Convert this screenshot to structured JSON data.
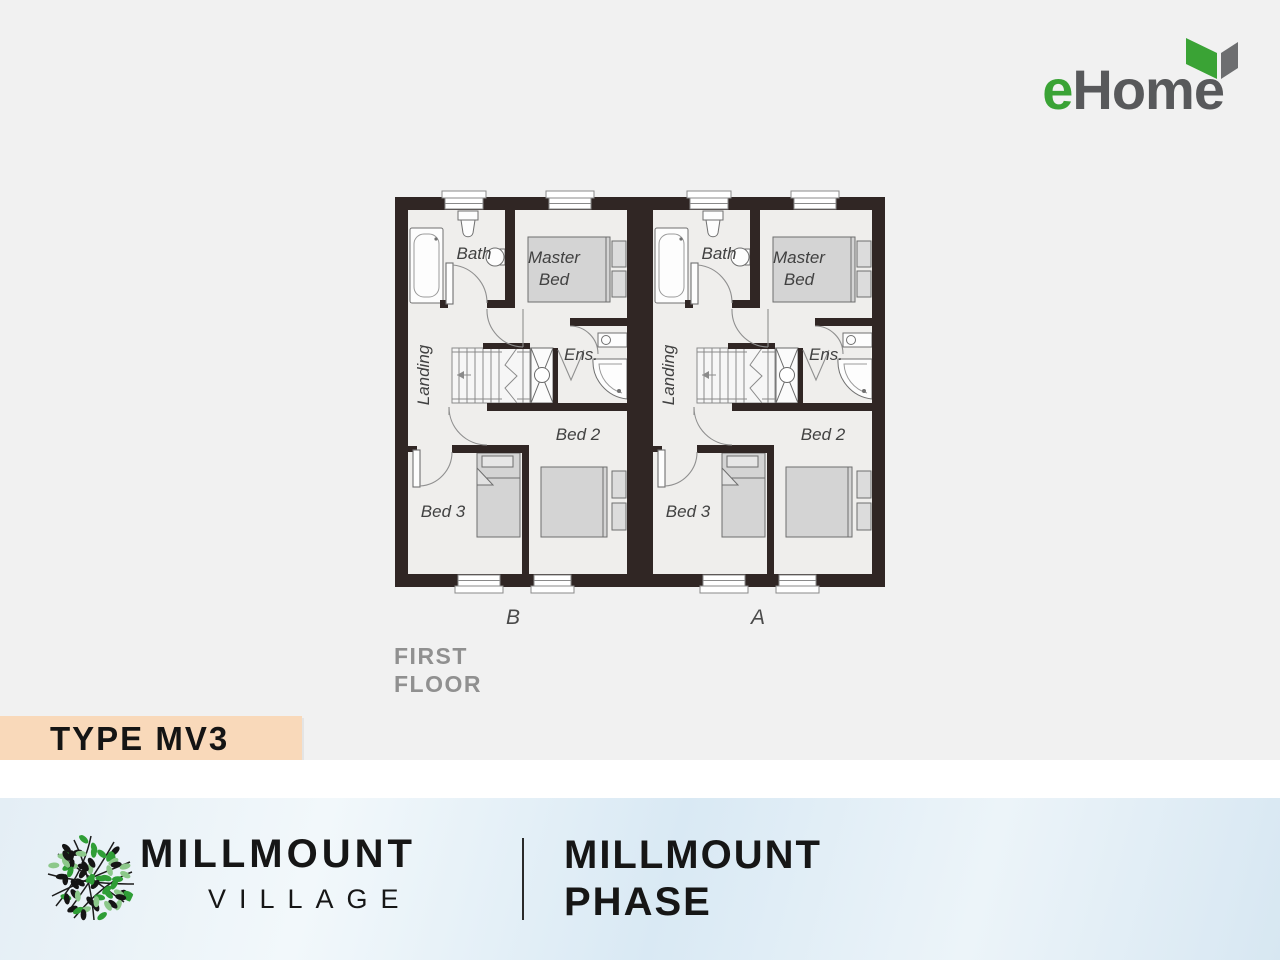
{
  "header": {
    "logo_e": "e",
    "logo_rest": "Home"
  },
  "plan": {
    "floor_line1": "FIRST",
    "floor_line2": "FLOOR",
    "unit_b_label": "B",
    "unit_a_label": "A",
    "rooms": {
      "bath": "Bath",
      "master_line1": "Master",
      "master_line2": "Bed",
      "ens": "Ens.",
      "bed2": "Bed 2",
      "bed3": "Bed 3",
      "landing": "Landing"
    }
  },
  "ribbon": {
    "label": "TYPE MV3"
  },
  "footer": {
    "brand": "MILLMOUNT",
    "brand_sub": "VILLAGE",
    "phase_line1": "MILLMOUNT",
    "phase_line2": "PHASE"
  },
  "colors": {
    "page_bg": "#f1f1f1",
    "wall": "#302624",
    "floor": "#efeeec",
    "furniture": "#d4d4d4",
    "ribbon_bg": "#f9d9ba",
    "logo_green": "#3aa335",
    "logo_gray": "#58595b",
    "footer_blue": "#d9e9f4",
    "leaf_green": "#2f9e36",
    "leaf_light_green": "#8cc88a",
    "leaf_black": "#151515"
  }
}
